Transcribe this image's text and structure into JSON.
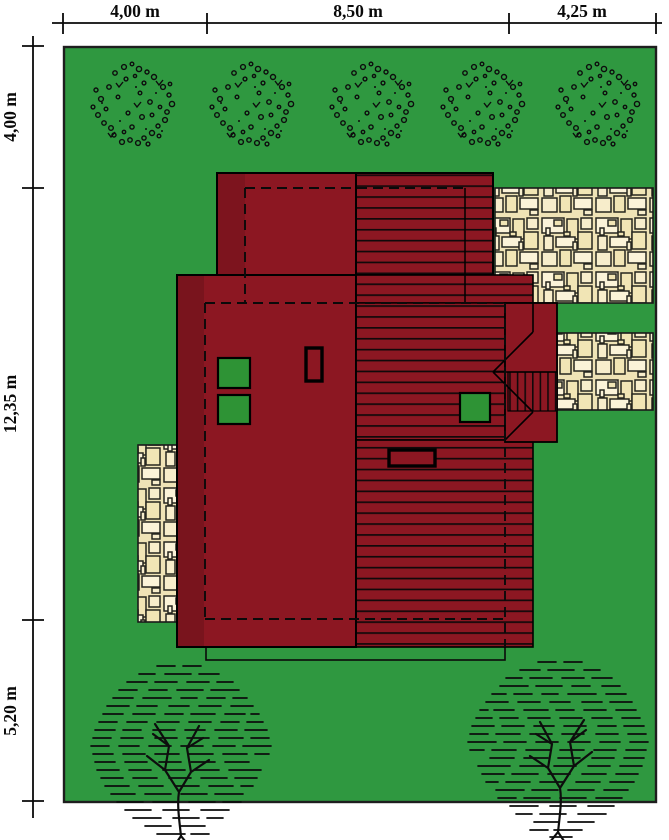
{
  "plan": {
    "type": "architectural-site-plan",
    "dimensions": {
      "top": [
        {
          "label": "4,00 m"
        },
        {
          "label": "8,50 m"
        },
        {
          "label": "4,25 m"
        }
      ],
      "left": [
        {
          "label": "4,00 m"
        },
        {
          "label": "12,35 m"
        },
        {
          "label": "5,20 m"
        }
      ],
      "unit": "m",
      "lot_width_m": 16.75,
      "lot_depth_m": 21.55
    },
    "colors": {
      "lawn": "#2F9840",
      "roof": "#8C1722",
      "roof_overhang_shade": "#7C1014",
      "skylight_green": "#2E9335",
      "stone_background": "#EFE3B6",
      "stone_light": "#FBF3D8",
      "stone_mid": "#F7EDCB",
      "stone_dark": "#F1E5B5",
      "line": "#000000",
      "page_background": "#FFFFFF"
    },
    "features": {
      "bush_count": 5,
      "tree_count": 2,
      "patio_count": 3,
      "skylight_count": 3,
      "chimney_count": 2
    }
  }
}
